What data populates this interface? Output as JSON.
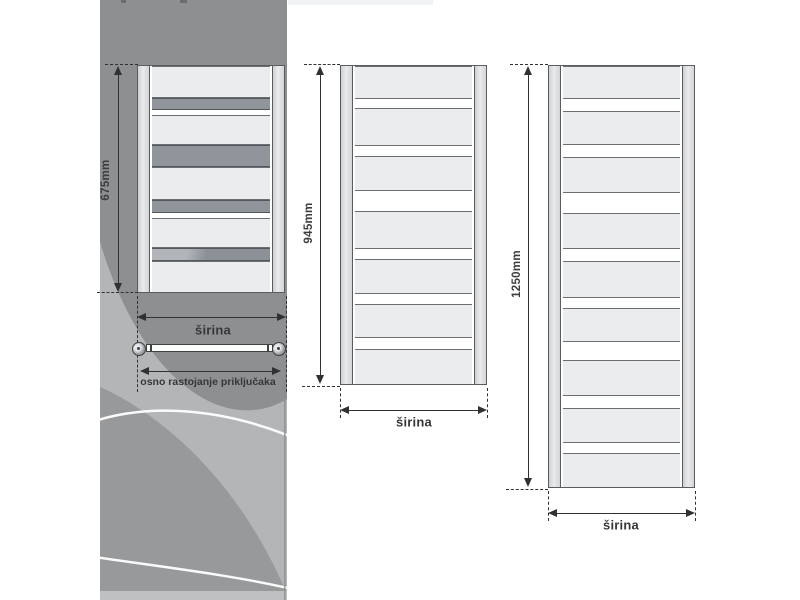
{
  "colors": {
    "dimension_ink": "#2f3133",
    "label_ink": "#3b3d3f",
    "radiator_panel_fill": "#eaeced",
    "radiator_crossbar_fill": "#8f959b",
    "radiator_tube_fill": "#dcdee0",
    "radiator_outline": "#595d61",
    "background_panel_dark": "#8e8f91",
    "background_panel_light": "#b4b5b6",
    "background_panel_blob": "#98999b",
    "background_panel_arc": "#ffffff"
  },
  "diagrams": [
    {
      "height_label": "675mm",
      "width_label": "širina",
      "connection_label": "osno rastojanje priključaka",
      "body": {
        "x": 137,
        "y": 65,
        "w": 148,
        "h": 228
      },
      "rows": [
        [
          "p",
          32
        ],
        [
          "s",
          12
        ],
        [
          "g",
          5
        ],
        [
          "p",
          30
        ],
        [
          "s",
          22
        ],
        [
          "p",
          33
        ],
        [
          "s",
          13
        ],
        [
          "g",
          5
        ],
        [
          "p",
          30
        ],
        [
          "x",
          13
        ],
        [
          "p",
          33
        ]
      ],
      "vdim": {
        "x": 118,
        "y1": 66,
        "y2": 292,
        "label_cx": 106,
        "label_cy": 180,
        "ext_top": [
          105,
          138,
          64
        ],
        "ext_bot": [
          97,
          138,
          292
        ]
      },
      "wdim": {
        "y": 317,
        "x1": 137,
        "x2": 286,
        "dash_y1": 296,
        "dash_y2": 392,
        "label_cx": 213,
        "label_cy": 330
      },
      "valve": {
        "pipe_y": 344,
        "pipe_h": 8,
        "x1": 146,
        "x2": 273,
        "fit_y": 342,
        "fx1": 132,
        "fx2": 272,
        "arrow_y": 371,
        "ax1": 140,
        "ax2": 281,
        "label_cx": 208,
        "label_cy": 382
      }
    },
    {
      "height_label": "945mm",
      "width_label": "širina",
      "body": {
        "x": 340,
        "y": 65,
        "w": 147,
        "h": 320
      },
      "rows": [
        [
          "p",
          33
        ],
        [
          "g",
          9
        ],
        [
          "p",
          38
        ],
        [
          "g",
          10
        ],
        [
          "p",
          35
        ],
        [
          "g",
          20
        ],
        [
          "p",
          38
        ],
        [
          "g",
          10
        ],
        [
          "p",
          35
        ],
        [
          "g",
          10
        ],
        [
          "p",
          34
        ],
        [
          "g",
          11
        ],
        [
          "p",
          37
        ]
      ],
      "vdim": {
        "x": 320,
        "y1": 66,
        "y2": 384,
        "label_cx": 309,
        "label_cy": 223,
        "ext_top": [
          304,
          340,
          64
        ],
        "ext_bot": [
          302,
          340,
          386
        ]
      },
      "wdim": {
        "y": 410,
        "x1": 340,
        "x2": 487,
        "dash_y1": 388,
        "dash_y2": 418,
        "label_cx": 414,
        "label_cy": 422
      }
    },
    {
      "height_label": "1250mm",
      "width_label": "širina",
      "body": {
        "x": 548,
        "y": 65,
        "w": 147,
        "h": 423
      },
      "rows": [
        [
          "p",
          33
        ],
        [
          "g",
          12
        ],
        [
          "p",
          34
        ],
        [
          "g",
          12
        ],
        [
          "p",
          36
        ],
        [
          "g",
          20
        ],
        [
          "p",
          36
        ],
        [
          "g",
          12
        ],
        [
          "p",
          37
        ],
        [
          "g",
          10
        ],
        [
          "p",
          34
        ],
        [
          "g",
          18
        ],
        [
          "p",
          36
        ],
        [
          "g",
          12
        ],
        [
          "p",
          35
        ],
        [
          "g",
          10
        ],
        [
          "p",
          36
        ]
      ],
      "vdim": {
        "x": 528,
        "y1": 66,
        "y2": 487,
        "label_cx": 517,
        "label_cy": 274,
        "ext_top": [
          510,
          548,
          64
        ],
        "ext_bot": [
          506,
          548,
          489
        ]
      },
      "wdim": {
        "y": 513,
        "x1": 548,
        "x2": 695,
        "dash_y1": 491,
        "dash_y2": 521,
        "label_cx": 621,
        "label_cy": 525
      }
    }
  ]
}
